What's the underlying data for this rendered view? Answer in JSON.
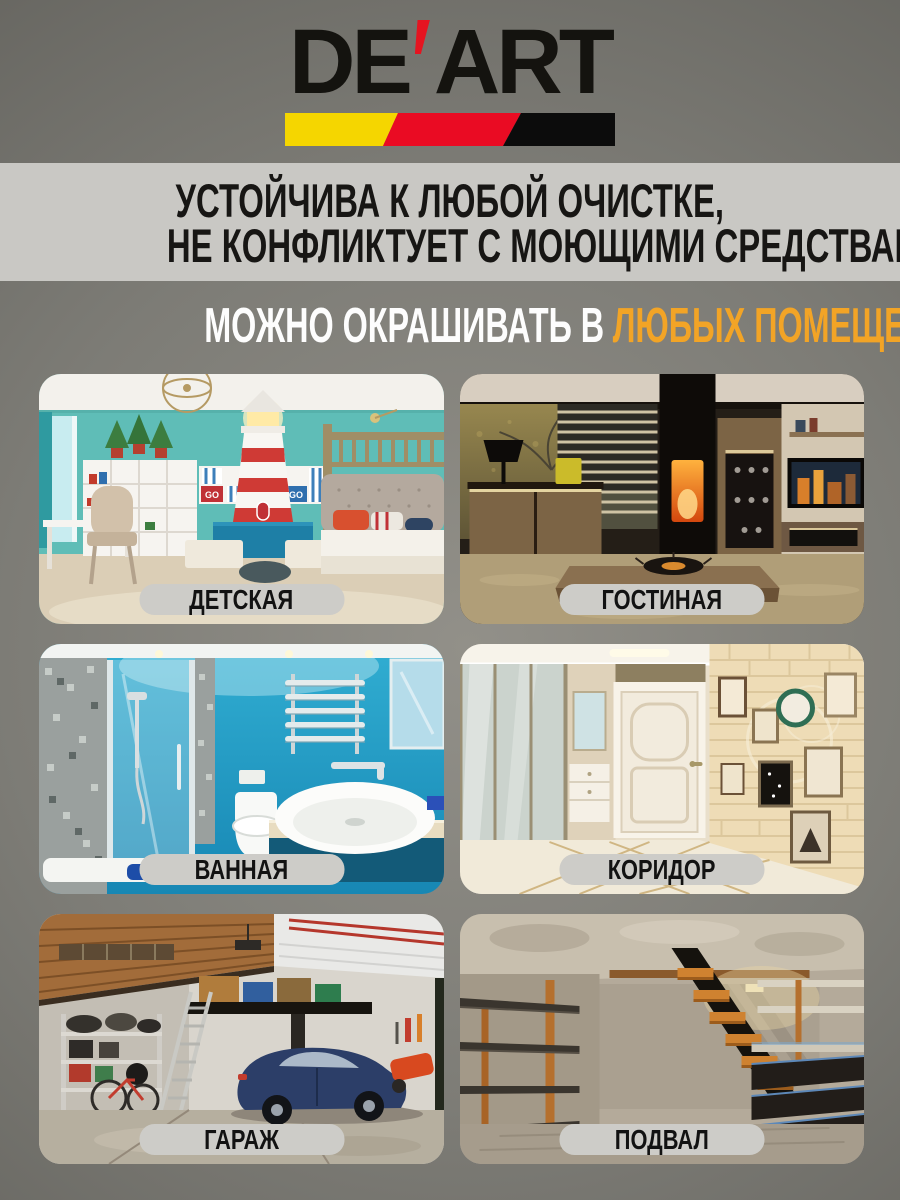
{
  "logo": {
    "part1": "DE",
    "part2": "ART",
    "apostrophe_color": "#e51420",
    "text_color": "#14130f",
    "stripe_colors": [
      "#f5d600",
      "#ea0b23",
      "#0c0c0c"
    ]
  },
  "banner": {
    "bg_color": "#c9c8c4",
    "text_color": "#171614",
    "line1": "УСТОЙЧИВА К ЛЮБОЙ ОЧИСТКЕ,",
    "line2": "НЕ КОНФЛИКТУЕТ С МОЮЩИМИ СРЕДСТВАМИ"
  },
  "headline": {
    "prefix": "МОЖНО ОКРАШИВАТЬ В",
    "highlight": "ЛЮБЫХ ПОМЕЩЕНИЯХ",
    "prefix_color": "#fdfdfd",
    "highlight_color": "#f2a426"
  },
  "label_pill": {
    "bg_color": "#cdccc8",
    "text_color": "#121212"
  },
  "page_background": {
    "center": "#929089",
    "edge": "#5b5a55"
  },
  "rooms": [
    {
      "label": "ДЕТСКАЯ",
      "go_label": "GO"
    },
    {
      "label": "ГОСТИНАЯ"
    },
    {
      "label": "ВАННАЯ"
    },
    {
      "label": "КОРИДОР"
    },
    {
      "label": "ГАРАЖ"
    },
    {
      "label": "ПОДВАЛ"
    }
  ]
}
